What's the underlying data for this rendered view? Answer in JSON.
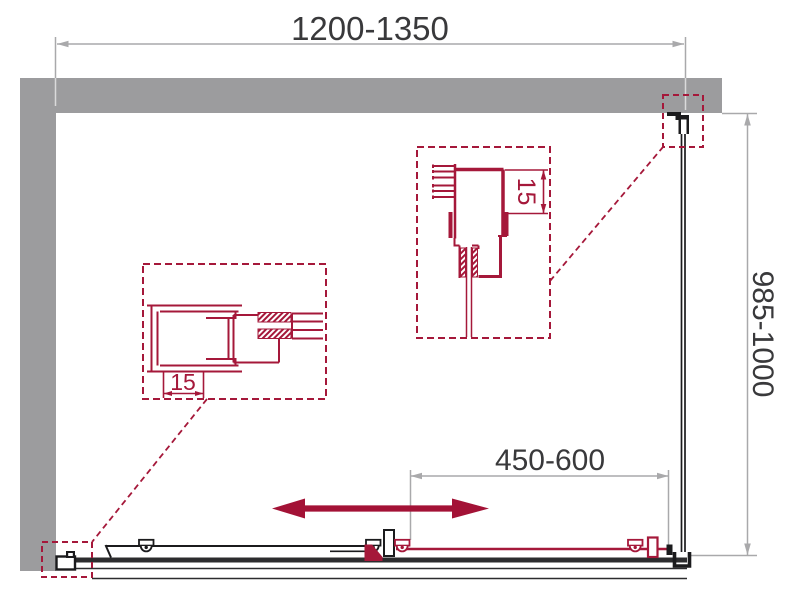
{
  "drawing": {
    "type": "shower-enclosure-installation-diagram",
    "dimensions": {
      "width": {
        "label": "1200-1350"
      },
      "height": {
        "label": "985-1000"
      },
      "door_travel": {
        "label": "450-600"
      }
    },
    "details": {
      "left": {
        "dim_label": "15"
      },
      "top": {
        "dim_label": "15"
      }
    },
    "icons": {
      "slide_direction_arrow": "double-headed-horizontal-arrow",
      "rollers": "wheel-bracket",
      "wall_profile": "clamp-bracket"
    },
    "colors": {
      "wall_gray": "#9C9C9E",
      "dimension_gray": "#A9A9AB",
      "dimension_gray_over_wall": "#DADADB",
      "text_dark": "#39393B",
      "accent_crimson": "#A5183A",
      "arrow_crimson": "#A31236",
      "ink_black": "#1B1B1D",
      "track_dark": "#2C2C2E",
      "background": "#FFFFFF"
    }
  }
}
